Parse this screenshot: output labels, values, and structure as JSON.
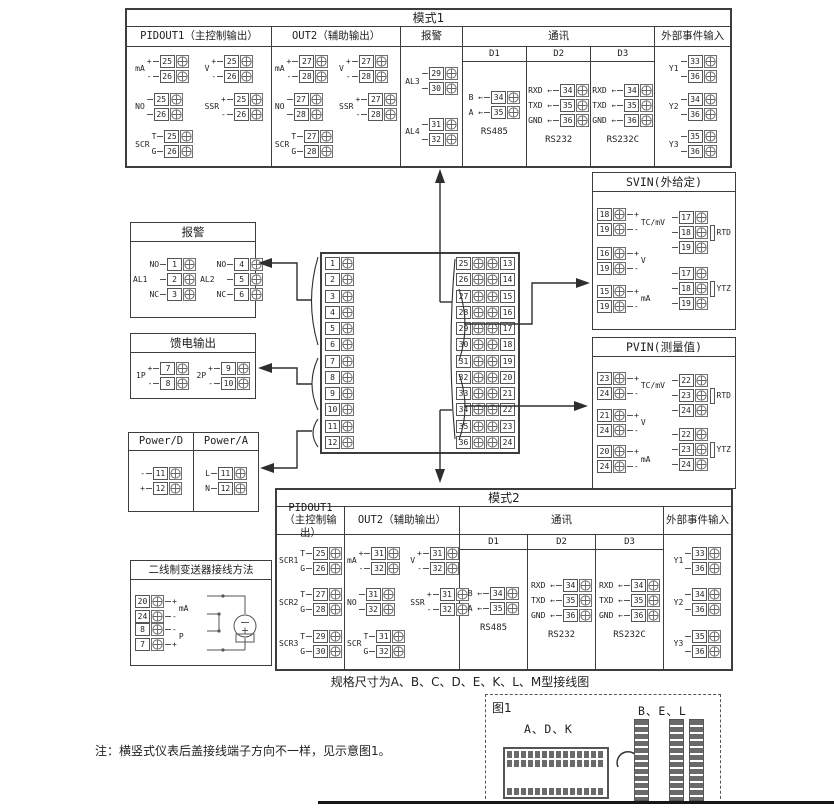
{
  "canvas": {
    "bg": "#ffffff",
    "ink": "#3d3d3d"
  },
  "mode1": {
    "title": "模式1",
    "columns": [
      {
        "header": "PIDOUT1（主控制输出）",
        "grid": 2,
        "groups": [
          {
            "label": "mA",
            "terms": [
              {
                "pre": "+",
                "num": "25"
              },
              {
                "pre": "-",
                "num": "26"
              }
            ]
          },
          {
            "label": "V",
            "terms": [
              {
                "pre": "+",
                "num": "25"
              },
              {
                "pre": "-",
                "num": "26"
              }
            ]
          },
          {
            "label": "NO",
            "terms": [
              {
                "num": "25"
              },
              {
                "num": "26"
              }
            ]
          },
          {
            "label": "SSR",
            "terms": [
              {
                "pre": "+",
                "num": "25"
              },
              {
                "pre": "-",
                "num": "26"
              }
            ]
          },
          {
            "label": "SCR",
            "terms": [
              {
                "pre": "T",
                "num": "25"
              },
              {
                "pre": "G",
                "num": "26"
              }
            ]
          }
        ]
      },
      {
        "header": "OUT2（辅助输出）",
        "grid": 2,
        "groups": [
          {
            "label": "mA",
            "terms": [
              {
                "pre": "+",
                "num": "27"
              },
              {
                "pre": "-",
                "num": "28"
              }
            ]
          },
          {
            "label": "V",
            "terms": [
              {
                "pre": "+",
                "num": "27"
              },
              {
                "pre": "-",
                "num": "28"
              }
            ]
          },
          {
            "label": "NO",
            "terms": [
              {
                "num": "27"
              },
              {
                "num": "28"
              }
            ]
          },
          {
            "label": "SSR",
            "terms": [
              {
                "pre": "+",
                "num": "27"
              },
              {
                "pre": "-",
                "num": "28"
              }
            ]
          },
          {
            "label": "SCR",
            "terms": [
              {
                "pre": "T",
                "num": "27"
              },
              {
                "pre": "G",
                "num": "28"
              }
            ]
          }
        ]
      },
      {
        "header": "报警",
        "grid": 1,
        "groups": [
          {
            "label": "AL3",
            "terms": [
              {
                "num": "29"
              },
              {
                "num": "30"
              }
            ]
          },
          {
            "label": "AL4",
            "terms": [
              {
                "num": "31"
              },
              {
                "num": "32"
              }
            ]
          }
        ]
      },
      {
        "header": "通讯",
        "subcols": [
          {
            "header": "D1",
            "caption": "RS485",
            "groups": [
              {
                "terms": [
                  {
                    "pre": "B ←",
                    "num": "34"
                  },
                  {
                    "pre": "A ←",
                    "num": "35"
                  }
                ]
              }
            ]
          },
          {
            "header": "D2",
            "caption": "RS232",
            "groups": [
              {
                "terms": [
                  {
                    "pre": "RXD ←",
                    "num": "34"
                  },
                  {
                    "pre": "TXD ←",
                    "num": "35"
                  },
                  {
                    "pre": "GND ←",
                    "num": "36"
                  }
                ]
              }
            ]
          },
          {
            "header": "D3",
            "caption": "RS232C",
            "groups": [
              {
                "terms": [
                  {
                    "pre": "RXD ←",
                    "num": "34"
                  },
                  {
                    "pre": "TXD ←",
                    "num": "35"
                  },
                  {
                    "pre": "GND ←",
                    "num": "36"
                  }
                ]
              }
            ]
          }
        ]
      },
      {
        "header": "外部事件输入",
        "grid": 1,
        "groups": [
          {
            "label": "Y1",
            "terms": [
              {
                "num": "33"
              },
              {
                "num": "36"
              }
            ]
          },
          {
            "label": "Y2",
            "terms": [
              {
                "num": "34"
              },
              {
                "num": "36"
              }
            ]
          },
          {
            "label": "Y3",
            "terms": [
              {
                "num": "35"
              },
              {
                "num": "36"
              }
            ]
          }
        ]
      }
    ]
  },
  "mode2": {
    "title": "模式2",
    "columns": [
      {
        "header": "PIDOUT1（主控制输出）",
        "grid": 1,
        "groups": [
          {
            "label": "SCR1",
            "terms": [
              {
                "pre": "T",
                "num": "25"
              },
              {
                "pre": "G",
                "num": "26"
              }
            ]
          },
          {
            "label": "SCR2",
            "terms": [
              {
                "pre": "T",
                "num": "27"
              },
              {
                "pre": "G",
                "num": "28"
              }
            ]
          },
          {
            "label": "SCR3",
            "terms": [
              {
                "pre": "T",
                "num": "29"
              },
              {
                "pre": "G",
                "num": "30"
              }
            ]
          }
        ]
      },
      {
        "header": "OUT2（辅助输出）",
        "grid": 2,
        "groups": [
          {
            "label": "mA",
            "terms": [
              {
                "pre": "+",
                "num": "31"
              },
              {
                "pre": "-",
                "num": "32"
              }
            ]
          },
          {
            "label": "V",
            "terms": [
              {
                "pre": "+",
                "num": "31"
              },
              {
                "pre": "-",
                "num": "32"
              }
            ]
          },
          {
            "label": "NO",
            "terms": [
              {
                "num": "31"
              },
              {
                "num": "32"
              }
            ]
          },
          {
            "label": "SSR",
            "terms": [
              {
                "pre": "+",
                "num": "31"
              },
              {
                "pre": "-",
                "num": "32"
              }
            ]
          },
          {
            "label": "SCR",
            "terms": [
              {
                "pre": "T",
                "num": "31"
              },
              {
                "pre": "G",
                "num": "32"
              }
            ]
          }
        ]
      },
      {
        "header": "通讯",
        "subcols": [
          {
            "header": "D1",
            "caption": "RS485",
            "groups": [
              {
                "terms": [
                  {
                    "pre": "B ←",
                    "num": "34"
                  },
                  {
                    "pre": "A ←",
                    "num": "35"
                  }
                ]
              }
            ]
          },
          {
            "header": "D2",
            "caption": "RS232",
            "groups": [
              {
                "terms": [
                  {
                    "pre": "RXD ←",
                    "num": "34"
                  },
                  {
                    "pre": "TXD ←",
                    "num": "35"
                  },
                  {
                    "pre": "GND ←",
                    "num": "36"
                  }
                ]
              }
            ]
          },
          {
            "header": "D3",
            "caption": "RS232C",
            "groups": [
              {
                "terms": [
                  {
                    "pre": "RXD ←",
                    "num": "34"
                  },
                  {
                    "pre": "TXD ←",
                    "num": "35"
                  },
                  {
                    "pre": "GND ←",
                    "num": "36"
                  }
                ]
              }
            ]
          }
        ]
      },
      {
        "header": "外部事件输入",
        "grid": 1,
        "groups": [
          {
            "label": "Y1",
            "terms": [
              {
                "num": "33"
              },
              {
                "num": "36"
              }
            ]
          },
          {
            "label": "Y2",
            "terms": [
              {
                "num": "34"
              },
              {
                "num": "36"
              }
            ]
          },
          {
            "label": "Y3",
            "terms": [
              {
                "num": "35"
              },
              {
                "num": "36"
              }
            ]
          }
        ]
      }
    ]
  },
  "alarm_box": {
    "title": "报警",
    "groups": [
      {
        "label": "AL1",
        "terms": [
          {
            "pre": "NO",
            "num": "1"
          },
          {
            "num": "2"
          },
          {
            "pre": "NC",
            "num": "3"
          }
        ]
      },
      {
        "label": "AL2",
        "terms": [
          {
            "pre": "NO",
            "num": "4"
          },
          {
            "num": "5"
          },
          {
            "pre": "NC",
            "num": "6"
          }
        ]
      }
    ]
  },
  "feed_box": {
    "title": "馈电输出",
    "groups": [
      {
        "label": "1P",
        "terms": [
          {
            "pre": "+",
            "num": "7"
          },
          {
            "pre": "-",
            "num": "8"
          }
        ]
      },
      {
        "label": "2P",
        "terms": [
          {
            "pre": "+",
            "num": "9"
          },
          {
            "pre": "-",
            "num": "10"
          }
        ]
      }
    ]
  },
  "power_box": {
    "cols": [
      {
        "title": "Power/D",
        "group": {
          "terms": [
            {
              "pre": "-",
              "num": "11"
            },
            {
              "pre": "+",
              "num": "12"
            }
          ]
        }
      },
      {
        "title": "Power/A",
        "group": {
          "terms": [
            {
              "pre": "L",
              "num": "11"
            },
            {
              "pre": "N",
              "num": "12"
            }
          ]
        }
      }
    ]
  },
  "transmitter_box": {
    "title": "二线制变送器接线方法",
    "groups": [
      {
        "label": "mA",
        "lpos": "r",
        "terms": [
          {
            "num": "20",
            "post": "+"
          },
          {
            "num": "24",
            "post": "-"
          }
        ]
      },
      {
        "label": "P",
        "lpos": "r",
        "terms": [
          {
            "num": "8",
            "post": "-"
          },
          {
            "num": "7",
            "post": "+"
          }
        ]
      }
    ]
  },
  "svin_box": {
    "title": "SVIN(外给定)",
    "left": [
      {
        "label": "TC/mV",
        "lpos": "r",
        "terms": [
          {
            "num": "18",
            "post": "+"
          },
          {
            "num": "19",
            "post": "-"
          }
        ]
      },
      {
        "label": "V",
        "lpos": "r",
        "terms": [
          {
            "num": "16",
            "post": "+"
          },
          {
            "num": "19",
            "post": "-"
          }
        ]
      },
      {
        "label": "mA",
        "lpos": "r",
        "terms": [
          {
            "num": "15",
            "post": "+"
          },
          {
            "num": "19",
            "post": "-"
          }
        ]
      }
    ],
    "right": [
      {
        "label": "RTD",
        "lpos": "r",
        "res": true,
        "terms": [
          {
            "num": "17"
          },
          {
            "num": "18"
          },
          {
            "num": "19"
          }
        ]
      },
      {
        "label": "YTZ",
        "lpos": "r",
        "res": true,
        "terms": [
          {
            "num": "17"
          },
          {
            "num": "18"
          },
          {
            "num": "19"
          }
        ]
      }
    ]
  },
  "pvin_box": {
    "title": "PVIN(测量值)",
    "left": [
      {
        "label": "TC/mV",
        "lpos": "r",
        "terms": [
          {
            "num": "23",
            "post": "+"
          },
          {
            "num": "24",
            "post": "-"
          }
        ]
      },
      {
        "label": "V",
        "lpos": "r",
        "terms": [
          {
            "num": "21",
            "post": "+"
          },
          {
            "num": "24",
            "post": "-"
          }
        ]
      },
      {
        "label": "mA",
        "lpos": "r",
        "terms": [
          {
            "num": "20",
            "post": "+"
          },
          {
            "num": "24",
            "post": "-"
          }
        ]
      }
    ],
    "right": [
      {
        "label": "RTD",
        "lpos": "r",
        "res": true,
        "terms": [
          {
            "num": "22"
          },
          {
            "num": "23"
          },
          {
            "num": "24"
          }
        ]
      },
      {
        "label": "YTZ",
        "lpos": "r",
        "res": true,
        "terms": [
          {
            "num": "22"
          },
          {
            "num": "23"
          },
          {
            "num": "24"
          }
        ]
      }
    ]
  },
  "terminal_block": {
    "left": [
      "1",
      "2",
      "3",
      "4",
      "5",
      "6",
      "7",
      "8",
      "9",
      "10",
      "11",
      "12"
    ],
    "pairs": [
      [
        "25",
        "13"
      ],
      [
        "26",
        "14"
      ],
      [
        "27",
        "15"
      ],
      [
        "28",
        "16"
      ],
      [
        "29",
        "17"
      ],
      [
        "30",
        "18"
      ],
      [
        "31",
        "19"
      ],
      [
        "32",
        "20"
      ],
      [
        "33",
        "21"
      ],
      [
        "34",
        "22"
      ],
      [
        "35",
        "23"
      ],
      [
        "36",
        "24"
      ]
    ]
  },
  "captions": {
    "spec": "规格尺寸为A、B、C、D、E、K、L、M型接线图",
    "note": "注：横竖式仪表后盖接线端子方向不一样，见示意图1。"
  },
  "figure1": {
    "label": "图1",
    "group_a": "A、D、K",
    "group_b": "B、E、L"
  }
}
